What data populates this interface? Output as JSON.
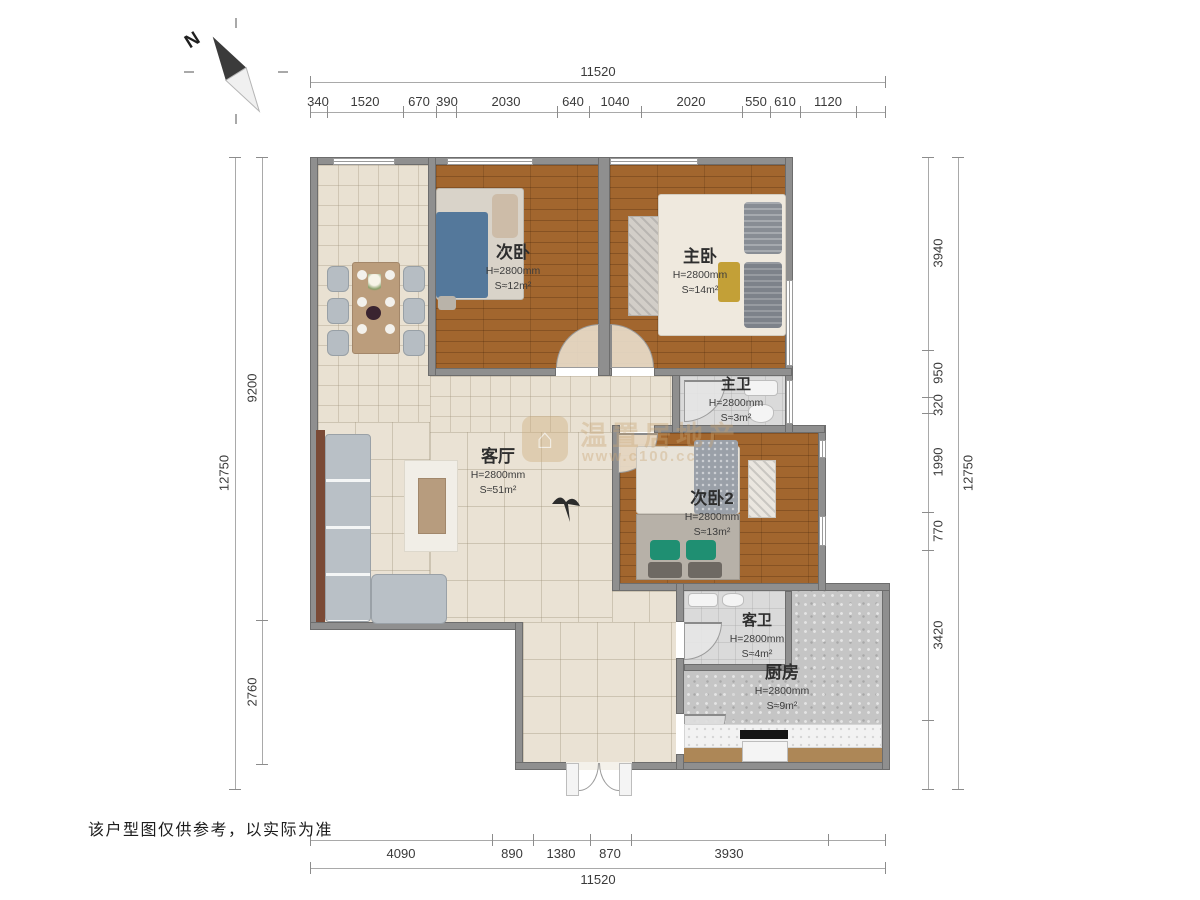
{
  "north": {
    "label": "N"
  },
  "disclaimer": "该户型图仅供参考，以实际为准",
  "watermark": {
    "brand": "温置居地产",
    "site": "www.c100.cc",
    "logo_icon": "house-icon"
  },
  "rooms": [
    {
      "name": "次卧",
      "height": "H=2800mm",
      "area": "S≈12m²"
    },
    {
      "name": "主卧",
      "height": "H=2800mm",
      "area": "S≈14m²"
    },
    {
      "name": "主卫",
      "height": "H=2800mm",
      "area": "S≈3m²"
    },
    {
      "name": "客厅",
      "height": "H=2800mm",
      "area": "S≈51m²"
    },
    {
      "name": "次卧2",
      "height": "H=2800mm",
      "area": "S≈13m²"
    },
    {
      "name": "客卫",
      "height": "H=2800mm",
      "area": "S≈4m²"
    },
    {
      "name": "厨房",
      "height": "H=2800mm",
      "area": "S≈9m²"
    }
  ],
  "dimensions": {
    "top": {
      "total": "11520",
      "segments": [
        "340",
        "1520",
        "670",
        "390",
        "2030",
        "640",
        "1040",
        "2020",
        "550",
        "610",
        "1120"
      ]
    },
    "bottom": {
      "total": "11520",
      "segments": [
        "4090",
        "890",
        "1380",
        "870",
        "3930"
      ]
    },
    "left": {
      "total": "12750",
      "segments": [
        "9200",
        "2760"
      ]
    },
    "right": {
      "total": "12750",
      "segments": [
        "3940",
        "950",
        "320",
        "1990",
        "770",
        "3420"
      ]
    }
  }
}
